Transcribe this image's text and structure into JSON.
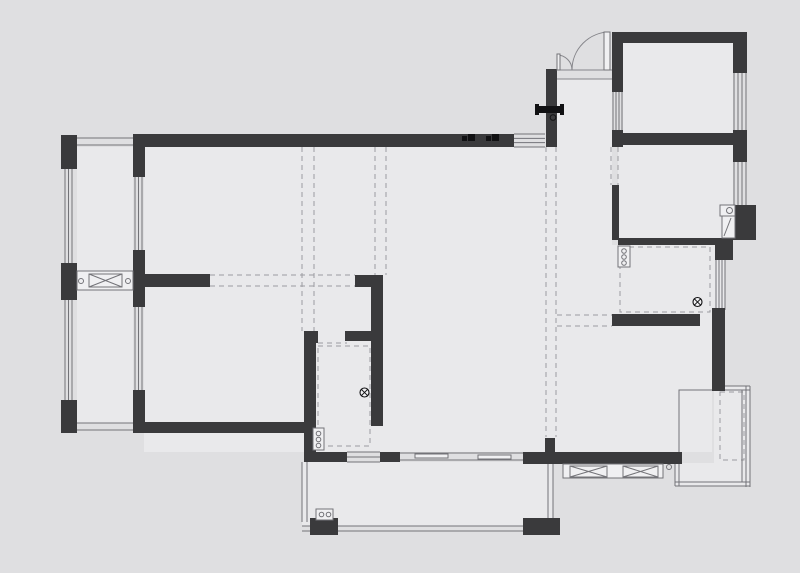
{
  "canvas": {
    "width": 800,
    "height": 573,
    "colors": {
      "background": "#dfdfe1",
      "floor": "#e9e9eb",
      "wall": "#3a3a3c",
      "thin_line": "#737378",
      "door_line": "#85858a",
      "dash_line": "#9c9ca0",
      "glyph": "#111113",
      "fixture_fill": "#f0f0f2"
    }
  },
  "floors": [
    [
      144,
      147,
      402,
      305
    ],
    [
      546,
      147,
      66,
      305
    ],
    [
      557,
      79,
      55,
      68
    ],
    [
      623,
      43,
      110,
      90
    ],
    [
      618,
      145,
      115,
      93
    ],
    [
      612,
      245,
      113,
      81
    ],
    [
      612,
      326,
      100,
      126
    ],
    [
      77,
      147,
      56,
      276
    ],
    [
      302,
      462,
      251,
      64
    ],
    [
      675,
      463,
      75,
      23
    ],
    [
      714,
      386,
      36,
      100
    ]
  ],
  "walls": [
    [
      61,
      135,
      16,
      34
    ],
    [
      61,
      263,
      16,
      37
    ],
    [
      61,
      400,
      16,
      33
    ],
    [
      133,
      134,
      381,
      13
    ],
    [
      133,
      147,
      12,
      30
    ],
    [
      133,
      250,
      12,
      57
    ],
    [
      133,
      390,
      12,
      43
    ],
    [
      144,
      274,
      66,
      13
    ],
    [
      144,
      422,
      160,
      11
    ],
    [
      304,
      331,
      14,
      12
    ],
    [
      304,
      331,
      12,
      131
    ],
    [
      345,
      331,
      26,
      10
    ],
    [
      355,
      275,
      28,
      12
    ],
    [
      371,
      275,
      12,
      66
    ],
    [
      371,
      341,
      12,
      85
    ],
    [
      304,
      452,
      43,
      10
    ],
    [
      380,
      452,
      20,
      10
    ],
    [
      523,
      452,
      159,
      12
    ],
    [
      545,
      438,
      10,
      14
    ],
    [
      546,
      69,
      11,
      78
    ],
    [
      612,
      32,
      135,
      11
    ],
    [
      612,
      32,
      11,
      60
    ],
    [
      612,
      130,
      11,
      17
    ],
    [
      612,
      133,
      135,
      12
    ],
    [
      733,
      32,
      14,
      41
    ],
    [
      733,
      130,
      14,
      32
    ],
    [
      733,
      205,
      23,
      35
    ],
    [
      618,
      238,
      97,
      7
    ],
    [
      715,
      238,
      18,
      22
    ],
    [
      612,
      185,
      7,
      55
    ],
    [
      612,
      314,
      88,
      12
    ],
    [
      712,
      308,
      13,
      83
    ],
    [
      310,
      518,
      28,
      17
    ],
    [
      523,
      518,
      37,
      17
    ]
  ],
  "windows": [
    [
      65,
      169,
      7,
      94,
      "v",
      3
    ],
    [
      65,
      300,
      7,
      100,
      "v",
      3
    ],
    [
      135,
      177,
      7,
      73,
      "v",
      3
    ],
    [
      135,
      307,
      7,
      83,
      "v",
      3
    ],
    [
      514,
      134,
      31,
      13,
      "h",
      4
    ],
    [
      613,
      92,
      9,
      38,
      "v",
      4
    ],
    [
      734,
      73,
      12,
      57,
      "v",
      4
    ],
    [
      734,
      162,
      12,
      43,
      "v",
      4
    ],
    [
      716,
      260,
      9,
      50,
      "v",
      4
    ],
    [
      347,
      452,
      33,
      10,
      "h",
      3
    ]
  ],
  "rails": [
    [
      77,
      138,
      56,
      7,
      "h",
      2
    ],
    [
      77,
      423,
      56,
      7,
      "h",
      2
    ],
    [
      302,
      462,
      5,
      60,
      "v",
      2
    ],
    [
      302,
      526,
      258,
      5,
      "h",
      2
    ],
    [
      548,
      462,
      5,
      60,
      "v",
      2
    ],
    [
      714,
      386,
      36,
      4,
      "h",
      2
    ],
    [
      746,
      386,
      4,
      101,
      "v",
      2
    ],
    [
      675,
      482,
      75,
      4,
      "h",
      2
    ],
    [
      675,
      463,
      4,
      23,
      "v",
      2
    ]
  ],
  "thin_rects": [
    [
      679,
      390,
      63,
      92
    ]
  ],
  "dashed_lines": [
    [
      302,
      147,
      302,
      331
    ],
    [
      314,
      147,
      314,
      331
    ],
    [
      375,
      147,
      375,
      275
    ],
    [
      386,
      147,
      386,
      275
    ],
    [
      546,
      147,
      546,
      437
    ],
    [
      556,
      147,
      556,
      437
    ],
    [
      210,
      275,
      355,
      275
    ],
    [
      210,
      286,
      355,
      286
    ],
    [
      557,
      315,
      612,
      315
    ],
    [
      557,
      326,
      612,
      326
    ],
    [
      318,
      343,
      347,
      343
    ],
    [
      611,
      147,
      611,
      185
    ],
    [
      618,
      147,
      618,
      185
    ]
  ],
  "dashed_rects": [
    [
      318,
      346,
      52,
      100
    ],
    [
      620,
      247,
      90,
      65
    ],
    [
      720,
      392,
      24,
      68
    ]
  ],
  "xbox_bands": [
    {
      "rect": [
        77,
        271,
        56,
        19
      ],
      "boxes": [
        [
          89,
          274,
          33,
          13
        ]
      ],
      "circles": [
        [
          81,
          281
        ],
        [
          128,
          281
        ]
      ]
    },
    {
      "rect": [
        563,
        464,
        100,
        14
      ],
      "boxes": [
        [
          570,
          466,
          37,
          11
        ],
        [
          623,
          466,
          35,
          11
        ]
      ],
      "circles": [
        [
          669,
          467
        ]
      ]
    }
  ],
  "sliding_door": {
    "lines": [
      [
        400,
        453,
        523,
        453
      ],
      [
        400,
        460,
        523,
        460
      ]
    ],
    "panels": [
      [
        415,
        454,
        33,
        4
      ],
      [
        478,
        455,
        33,
        4
      ]
    ]
  },
  "entry_door": {
    "leaves": [
      [
        604,
        32,
        6,
        38
      ],
      [
        557,
        54,
        3,
        16
      ]
    ],
    "arcs": [
      "M 572 70 A 38 38 0 0 1 610 32",
      "M 572 70 A 15 15 0 0 0 557 55"
    ],
    "jambs": [
      [
        557,
        70,
        612,
        70
      ],
      [
        557,
        79,
        612,
        79
      ]
    ]
  },
  "fans": [
    [
      364.5,
      392.5,
      4.5
    ],
    [
      697.5,
      302,
      4.5
    ]
  ],
  "circle_strips": [
    {
      "rect": [
        313,
        428,
        11,
        22
      ],
      "circles": [
        [
          318.5,
          433.5
        ],
        [
          318.5,
          439.5
        ],
        [
          318.5,
          445.5
        ]
      ]
    },
    {
      "rect": [
        618,
        246,
        12,
        21
      ],
      "circles": [
        [
          624,
          251
        ],
        [
          624,
          257
        ],
        [
          624,
          263
        ]
      ]
    },
    {
      "rect": [
        316,
        509,
        17,
        11
      ],
      "circles": [
        [
          321.5,
          514.5
        ],
        [
          328.5,
          514.5
        ]
      ]
    }
  ],
  "basin": {
    "rect": [
      720,
      205,
      15,
      11
    ],
    "circle": [
      729.5,
      210.5,
      3
    ],
    "lower": [
      722,
      216,
      13,
      22
    ],
    "diag": [
      724,
      236,
      731,
      218
    ]
  },
  "wall_glyphs": [
    [
      462,
      134
    ],
    [
      486,
      134
    ]
  ],
  "valve": {
    "bar": [
      538,
      106,
      25,
      7
    ],
    "nubs": [
      [
        535,
        104,
        4,
        11
      ],
      [
        560,
        104,
        4,
        11
      ]
    ],
    "circle": [
      553,
      117.5,
      2.8
    ]
  }
}
